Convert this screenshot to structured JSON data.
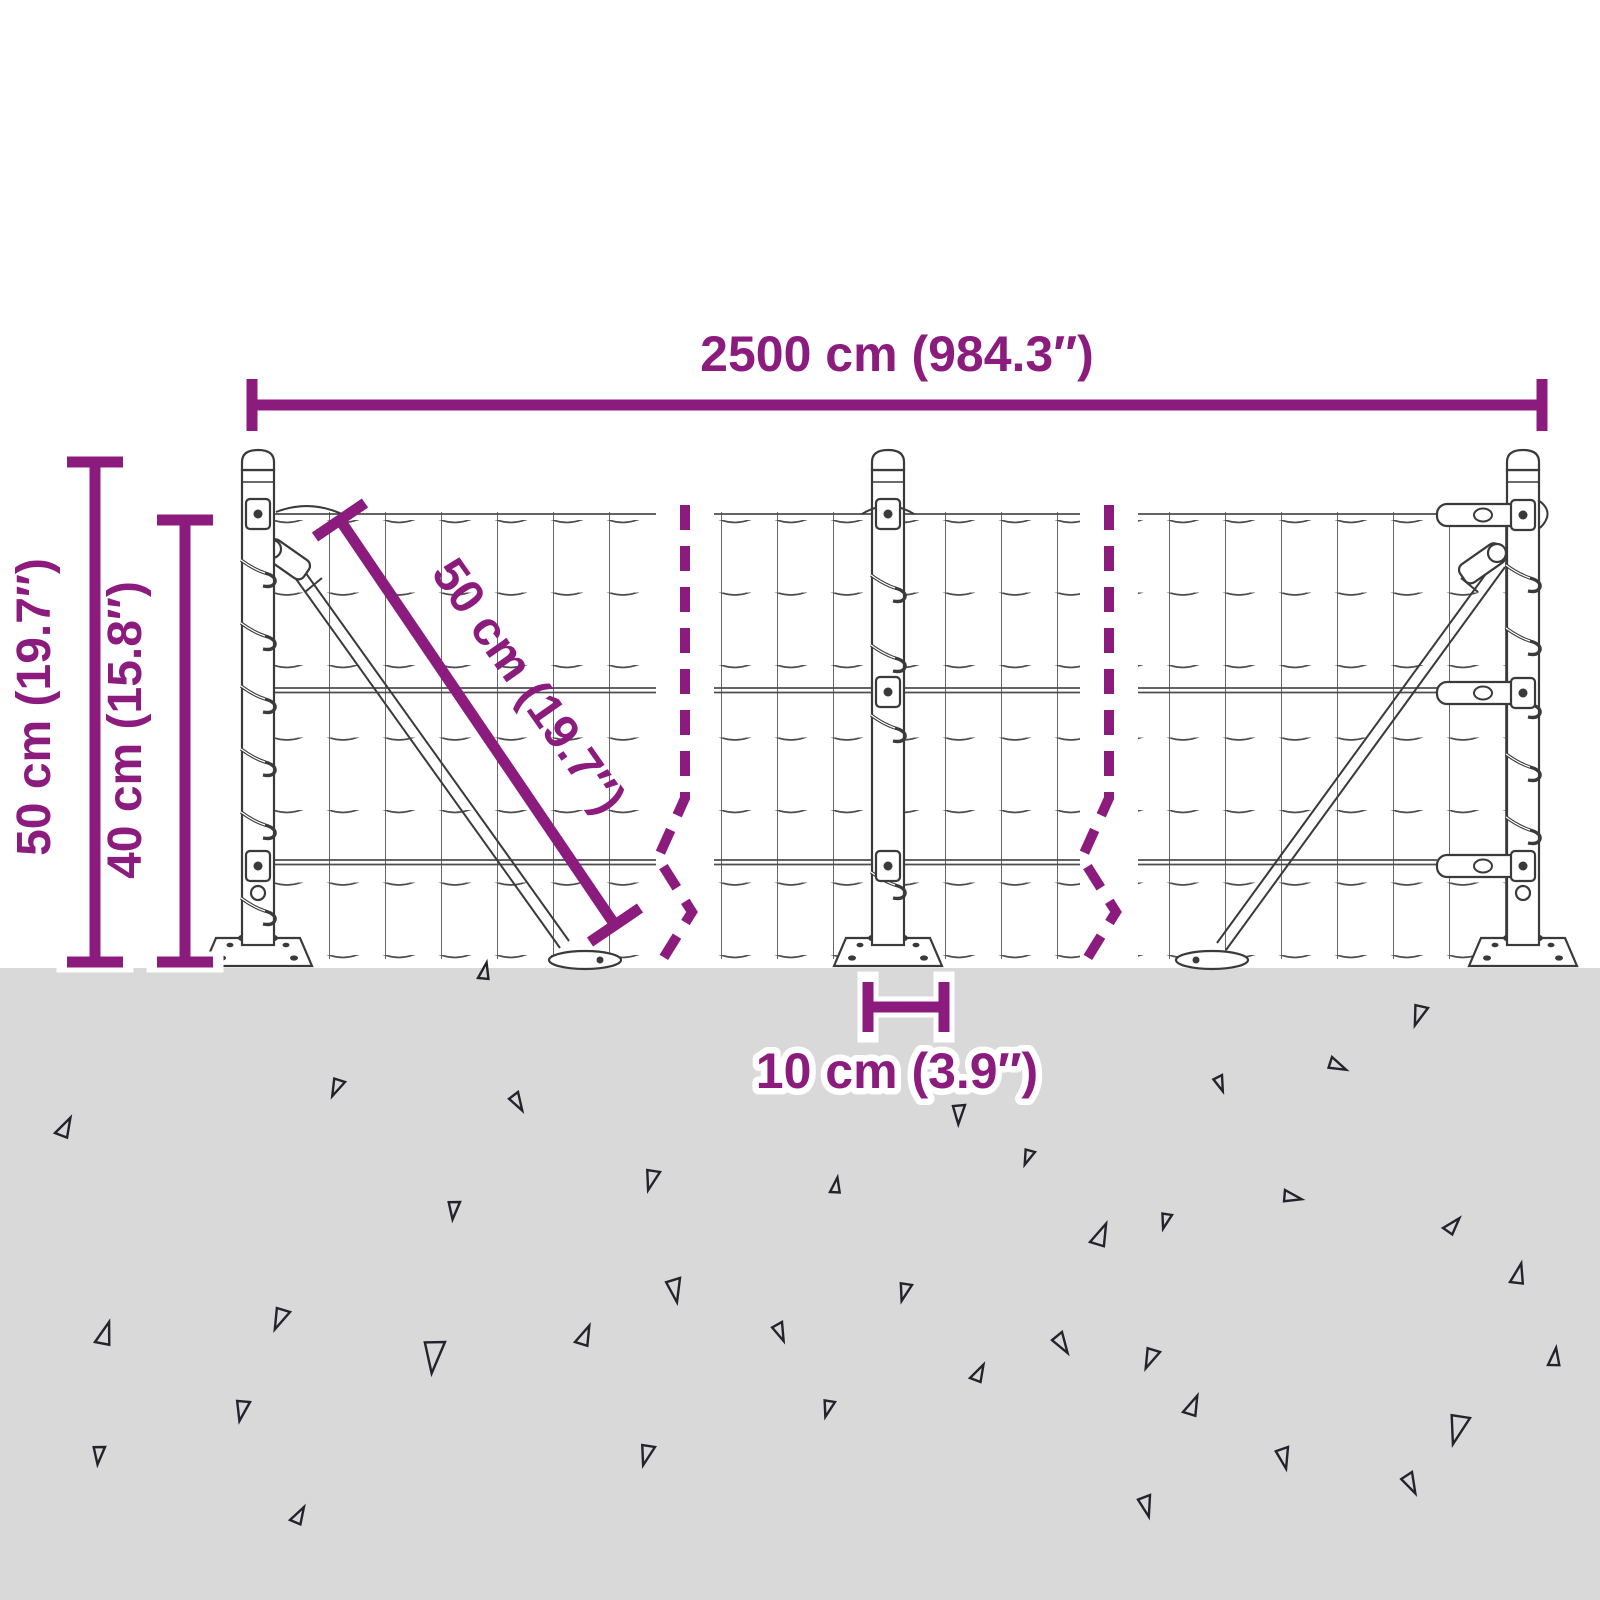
{
  "dimensions": {
    "total_length": "2500 cm (984.3″)",
    "post_height": "50 cm (19.7″)",
    "mesh_height": "40 cm (15.8″)",
    "brace_length": "50 cm (19.7″)",
    "anchor_width": "10 cm (3.9″)"
  },
  "colors": {
    "dimension": "#8C1B7E",
    "ground": "#D9D9D9",
    "wire": "#4d4d4d",
    "hardware": "#3a3a3a",
    "triangle": "#23232e"
  },
  "ground": {
    "triangles": [
      {
        "x": 478,
        "y": 978,
        "s": 0.65,
        "r": 12
      },
      {
        "x": 1428,
        "y": 1008,
        "s": 0.8,
        "r": 200
      },
      {
        "x": 345,
        "y": 1082,
        "s": 0.7,
        "r": 205
      },
      {
        "x": 518,
        "y": 1092,
        "s": 0.7,
        "r": 150
      },
      {
        "x": 1222,
        "y": 1075,
        "s": 0.6,
        "r": 160
      },
      {
        "x": 1332,
        "y": 1057,
        "s": 0.7,
        "r": 115
      },
      {
        "x": 965,
        "y": 1105,
        "s": 0.75,
        "r": 182
      },
      {
        "x": 55,
        "y": 1133,
        "s": 0.8,
        "r": 28
      },
      {
        "x": 660,
        "y": 1172,
        "s": 0.8,
        "r": 196
      },
      {
        "x": 1035,
        "y": 1152,
        "s": 0.6,
        "r": 202
      },
      {
        "x": 460,
        "y": 1202,
        "s": 0.7,
        "r": 186
      },
      {
        "x": 830,
        "y": 1192,
        "s": 0.6,
        "r": 10
      },
      {
        "x": 1285,
        "y": 1190,
        "s": 0.7,
        "r": 102
      },
      {
        "x": 1090,
        "y": 1242,
        "s": 0.9,
        "r": 24
      },
      {
        "x": 1172,
        "y": 1215,
        "s": 0.6,
        "r": 196
      },
      {
        "x": 1443,
        "y": 1228,
        "s": 0.7,
        "r": 42
      },
      {
        "x": 680,
        "y": 1278,
        "s": 0.9,
        "r": 170
      },
      {
        "x": 912,
        "y": 1285,
        "s": 0.7,
        "r": 196
      },
      {
        "x": 1510,
        "y": 1282,
        "s": 0.8,
        "r": 14
      },
      {
        "x": 290,
        "y": 1312,
        "s": 0.85,
        "r": 204
      },
      {
        "x": 95,
        "y": 1342,
        "s": 0.9,
        "r": 18
      },
      {
        "x": 445,
        "y": 1342,
        "s": 1.25,
        "r": 186
      },
      {
        "x": 575,
        "y": 1342,
        "s": 0.8,
        "r": 24
      },
      {
        "x": 782,
        "y": 1322,
        "s": 0.7,
        "r": 158
      },
      {
        "x": 1062,
        "y": 1332,
        "s": 0.8,
        "r": 148
      },
      {
        "x": 1160,
        "y": 1352,
        "s": 0.8,
        "r": 204
      },
      {
        "x": 250,
        "y": 1402,
        "s": 0.8,
        "r": 192
      },
      {
        "x": 970,
        "y": 1378,
        "s": 0.7,
        "r": 28
      },
      {
        "x": 835,
        "y": 1402,
        "s": 0.65,
        "r": 196
      },
      {
        "x": 1470,
        "y": 1418,
        "s": 1.15,
        "r": 196
      },
      {
        "x": 1548,
        "y": 1365,
        "s": 0.7,
        "r": 8
      },
      {
        "x": 1183,
        "y": 1412,
        "s": 0.8,
        "r": 24
      },
      {
        "x": 1288,
        "y": 1447,
        "s": 0.8,
        "r": 168
      },
      {
        "x": 1412,
        "y": 1472,
        "s": 0.8,
        "r": 154
      },
      {
        "x": 1150,
        "y": 1495,
        "s": 0.8,
        "r": 166
      },
      {
        "x": 105,
        "y": 1447,
        "s": 0.7,
        "r": 186
      },
      {
        "x": 655,
        "y": 1447,
        "s": 0.8,
        "r": 196
      },
      {
        "x": 290,
        "y": 1520,
        "s": 0.7,
        "r": 30
      }
    ]
  }
}
